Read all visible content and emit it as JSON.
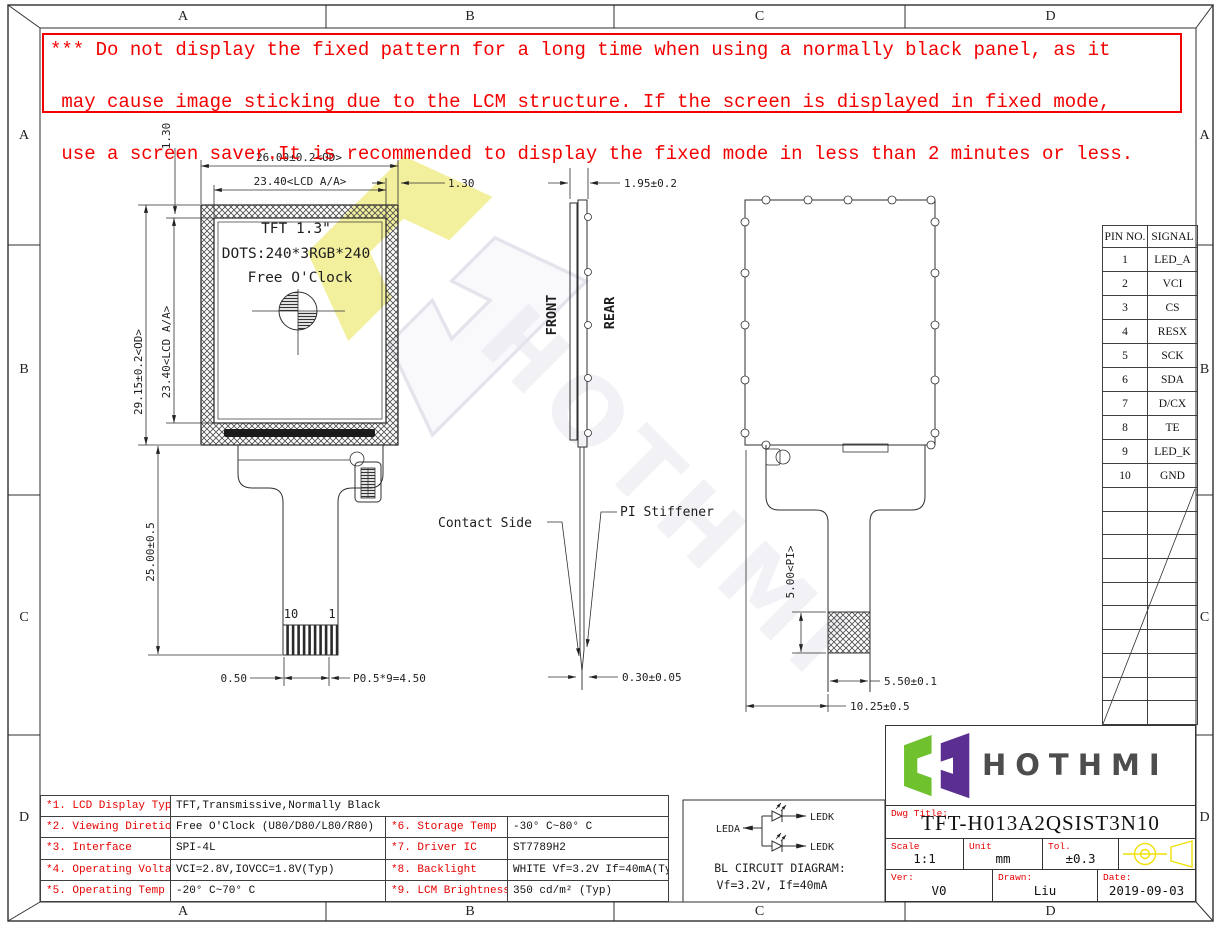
{
  "sheet": {
    "grid": {
      "cols": [
        "A",
        "B",
        "C",
        "D"
      ],
      "rows": [
        "A",
        "B",
        "C",
        "D"
      ]
    },
    "warning_lines": [
      "*** Do not display the fixed pattern for a long time when using a normally black panel, as it",
      " may cause image sticking due to the LCM structure. If the screen is displayed in fixed mode,",
      " use a screen saver.It is recommended to display the fixed mode in less than 2 minutes or less."
    ],
    "watermark_text": "HOTHMI"
  },
  "front_view": {
    "panel_line1": "TFT 1.3\"",
    "panel_line2": "DOTS:240*3RGB*240",
    "panel_line3": "Free O'Clock",
    "dim_od_width": "26.00±0.2<OD>",
    "dim_aa_width": "23.40<LCD A/A>",
    "dim_top_bezel": "1.30",
    "dim_side_bezel": "1.30",
    "dim_od_height": "29.15±0.2<OD>",
    "dim_aa_height": "23.40<LCD A/A>",
    "dim_fpc_length": "25.00±0.5",
    "dim_pin_margin": "0.50",
    "dim_pin_pitch": "P0.5*9=4.50",
    "pin_first": "10",
    "pin_last": "1"
  },
  "side_view": {
    "front_label": "FRONT",
    "rear_label": "REAR",
    "dim_thickness": "1.95±0.2",
    "dim_fpc_thickness": "0.30±0.05",
    "contact_side_label": "Contact Side",
    "pi_stiffener_label": "PI Stiffener"
  },
  "rear_view": {
    "dim_pi": "5.00<PI>",
    "dim_tail_width": "5.50±0.1",
    "dim_tail_offset": "10.25±0.5"
  },
  "pin_table": {
    "headers": [
      "PIN NO.",
      "SIGNAL"
    ],
    "rows": [
      [
        "1",
        "LED_A"
      ],
      [
        "2",
        "VCI"
      ],
      [
        "3",
        "CS"
      ],
      [
        "4",
        "RESX"
      ],
      [
        "5",
        "SCK"
      ],
      [
        "6",
        "SDA"
      ],
      [
        "7",
        "D/CX"
      ],
      [
        "8",
        "TE"
      ],
      [
        "9",
        "LED_K"
      ],
      [
        "10",
        "GND"
      ]
    ]
  },
  "spec_table": {
    "rows": [
      [
        "*1. LCD Display Type",
        "TFT,Transmissive,Normally Black"
      ],
      [
        "*2. Viewing Diretion",
        "Free O'Clock (U80/D80/L80/R80)",
        "*6. Storage Temp",
        "-30° C~80° C"
      ],
      [
        "*3. Interface",
        "SPI-4L",
        "*7. Driver IC",
        "ST7789H2"
      ],
      [
        "*4. Operating Voltage",
        "VCI=2.8V,IOVCC=1.8V(Typ)",
        "*8. Backlight",
        "WHITE Vf=3.2V If=40mA(Typ)"
      ],
      [
        "*5. Operating Temp",
        "-20° C~70° C",
        "*9. LCM Brightness",
        "350 cd/m² (Typ)"
      ]
    ]
  },
  "bl_circuit": {
    "input_label": "LEDA",
    "output_label_top": "LEDK",
    "output_label_bottom": "LEDK",
    "title": "BL CIRCUIT DIAGRAM:",
    "subtitle": "Vf=3.2V, If=40mA"
  },
  "title_block": {
    "brand": "HOTHMI",
    "dwg_title_label": "Dwg Title:",
    "dwg_title": "TFT-H013A2QSIST3N10",
    "scale_label": "Scale",
    "scale_value": "1:1",
    "unit_label": "Unit",
    "unit_value": "mm",
    "tol_label": "Tol.",
    "tol_value": "±0.3",
    "ver_label": "Ver:",
    "ver_value": "V0",
    "drawn_label": "Drawn:",
    "drawn_value": "Liu",
    "date_label": "Date:",
    "date_value": "2019-09-03"
  },
  "colors": {
    "accent_red": "#e60000",
    "line_dark": "#2f2f2f",
    "logo_green": "#6fc22e",
    "logo_purple": "#5b2e91",
    "symbol_yellow": "#efe006",
    "watermark_yellow": "#f0ec7d",
    "watermark_gray": "#e6e6ef"
  }
}
